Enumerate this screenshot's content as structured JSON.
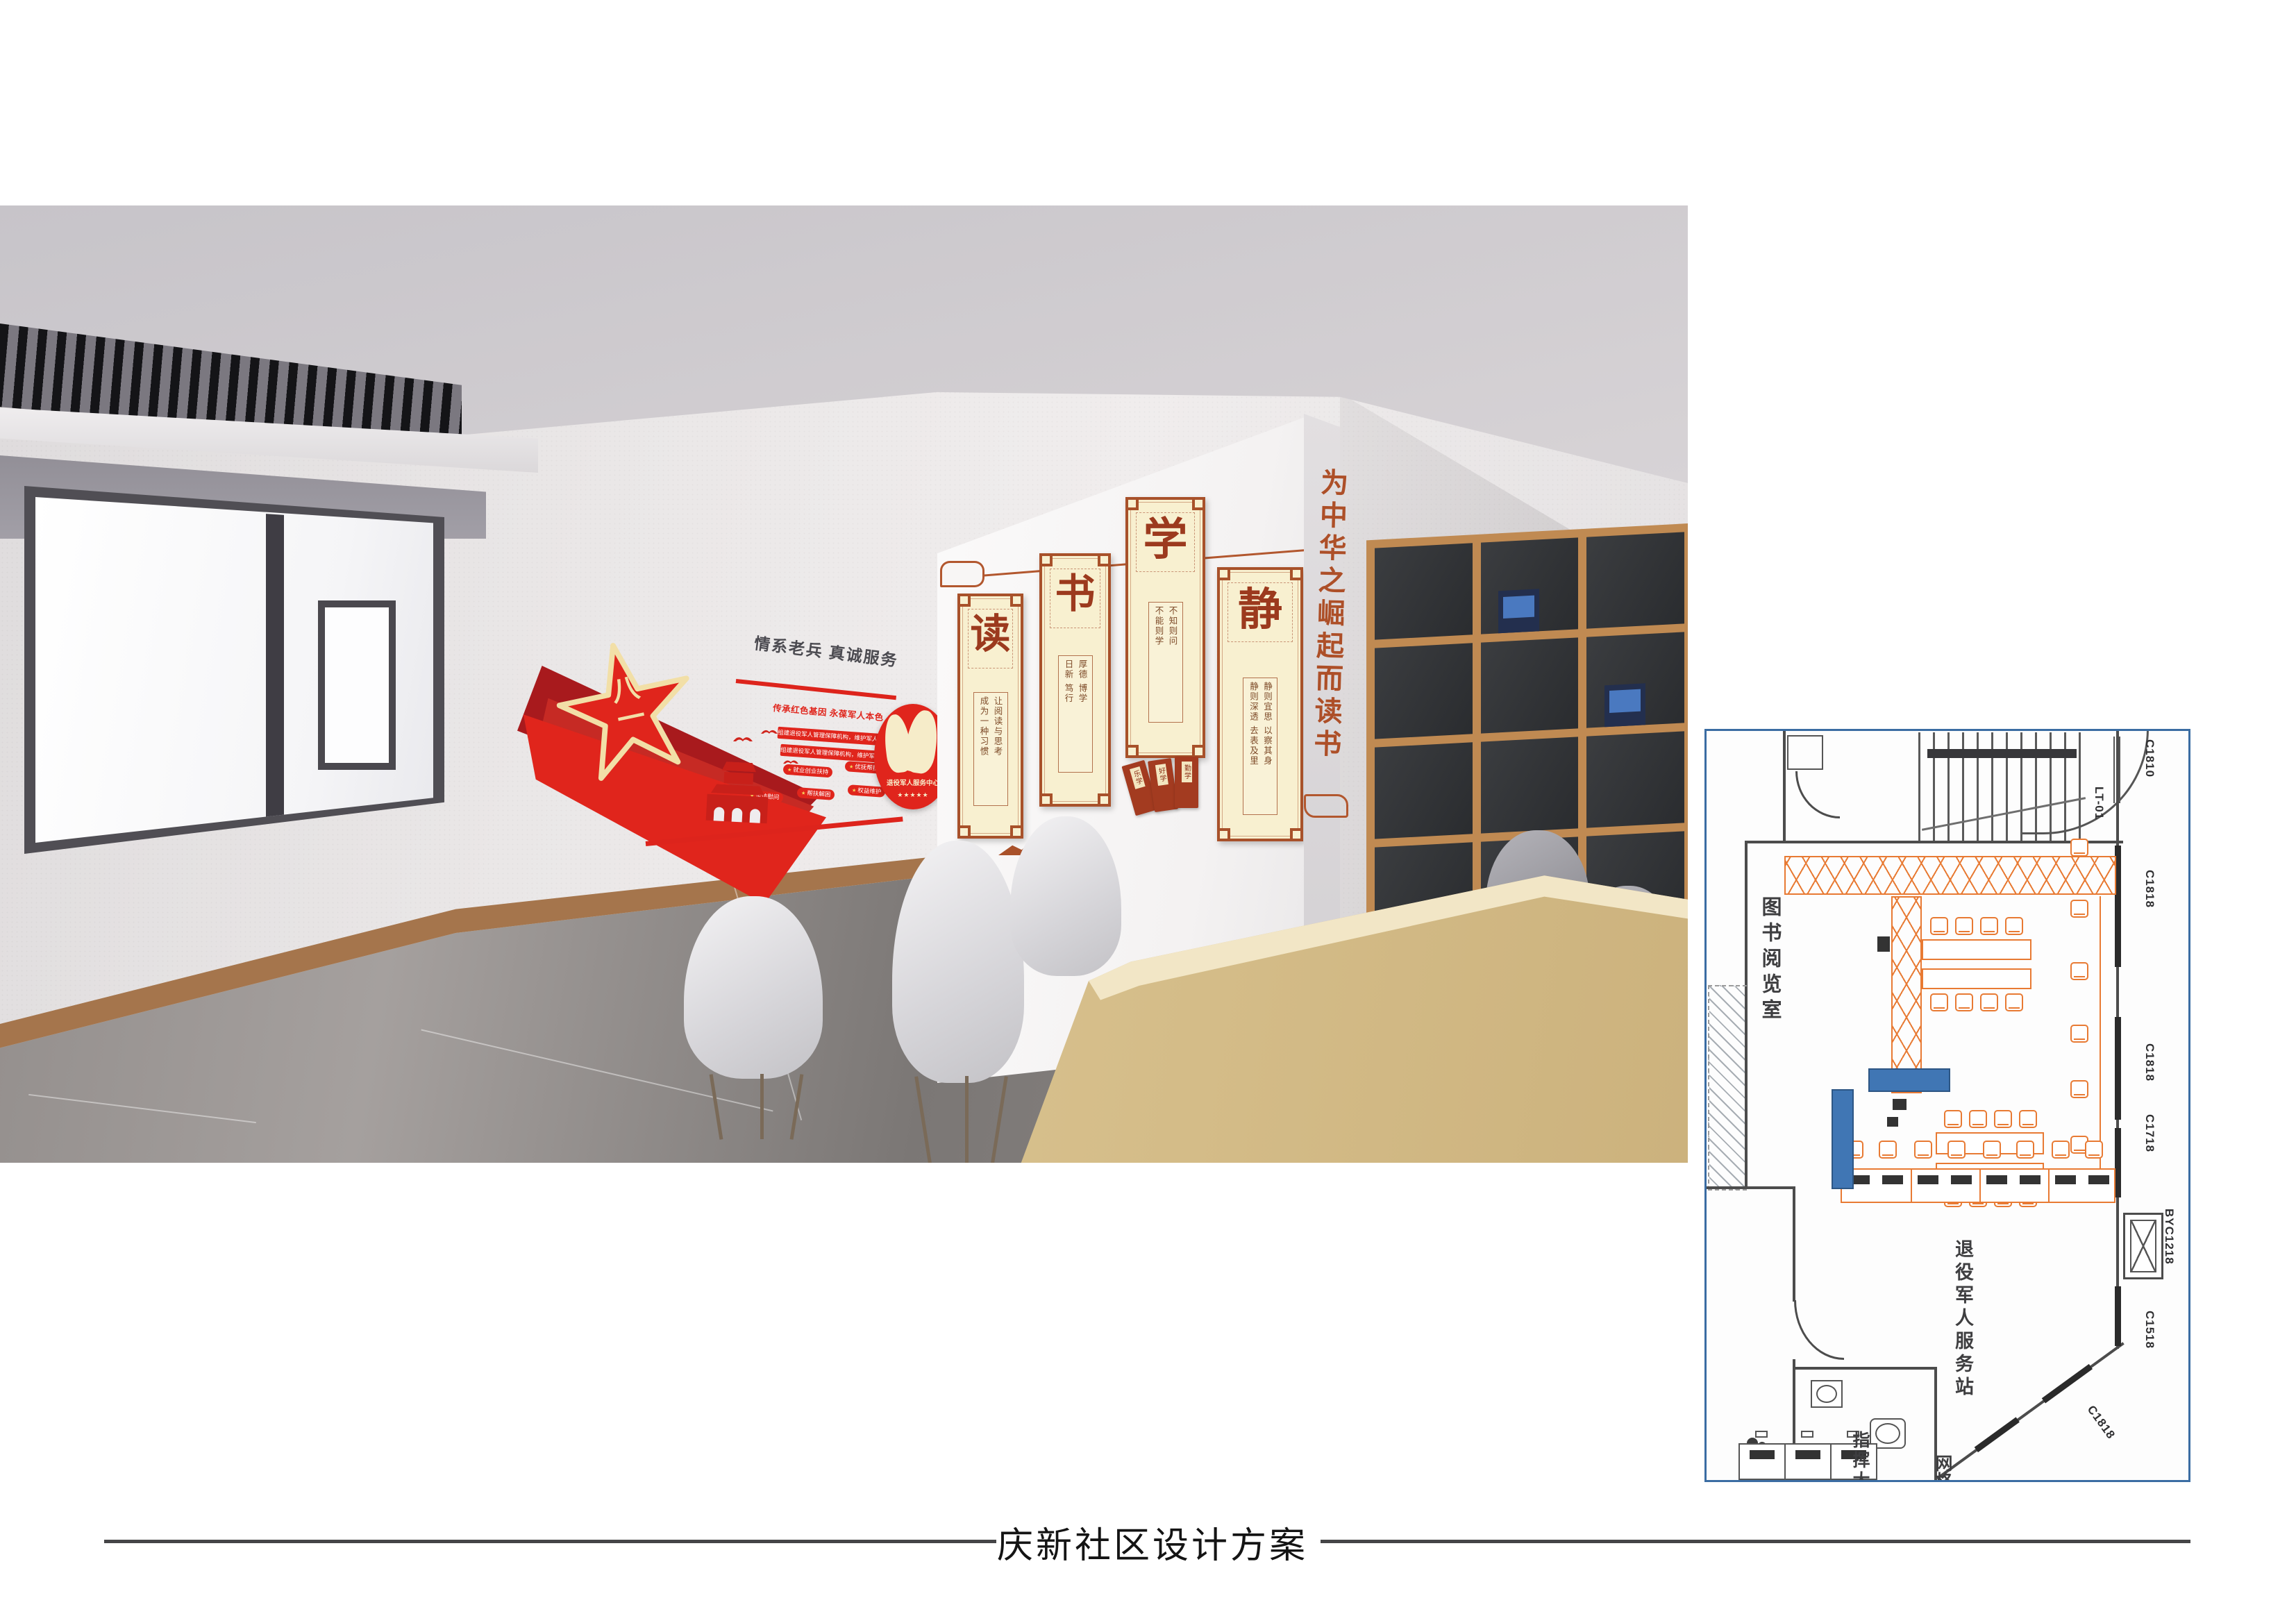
{
  "colors": {
    "red": "#e0251c",
    "red-dark": "#a81a1d",
    "gold": "#f2dfa7",
    "scroll-frame": "#a8512a",
    "scroll-bg": "#f8f0d0",
    "plan-orange": "#e87a33",
    "plan-blue": "#3b6da3",
    "hl-blue": "#4076b4"
  },
  "render": {
    "culture_wall": {
      "headline": "情系老兵 真诚服务",
      "subheadline": "传承红色基因 永葆军人本色",
      "emblem": "八一",
      "policy_bars": [
        "组建退役军人管理保障机构，维护军人军属合法权益。",
        "组建退役军人管理保障机构，维护军人军属合法权益。"
      ],
      "badges": [
        "就业创业扶持",
        "优抚帮扶",
        "走访慰问",
        "帮扶解困",
        "权益维护"
      ],
      "service_center": {
        "label": "退役军人服务中心",
        "stars": "★★★★★"
      }
    },
    "reading_wall": {
      "slogan": "为中华之崛起而读书",
      "scrolls": [
        {
          "char": "读",
          "line1": "让阅读与思考",
          "line2": "成为一种习惯"
        },
        {
          "char": "书",
          "line1": "厚德  博学",
          "line2": "日新  笃行"
        },
        {
          "char": "学",
          "line1": "不知则问",
          "line2": "不能则学"
        },
        {
          "char": "静",
          "line1": "静则宜思  以察其身",
          "line2": "静则深透  去表及里"
        }
      ],
      "booklets": [
        "乐学",
        "好学",
        "勤学"
      ]
    }
  },
  "floor_plan": {
    "room_labels": [
      "图书阅览室",
      "退役军人服务站",
      "指挥大厅",
      "网格"
    ],
    "window_labels": [
      "C1810",
      "LT-01",
      "C1818",
      "C1818",
      "C1718",
      "BYC1218",
      "C1518",
      "C1818"
    ]
  },
  "footer": {
    "title": "庆新社区设计方案"
  }
}
